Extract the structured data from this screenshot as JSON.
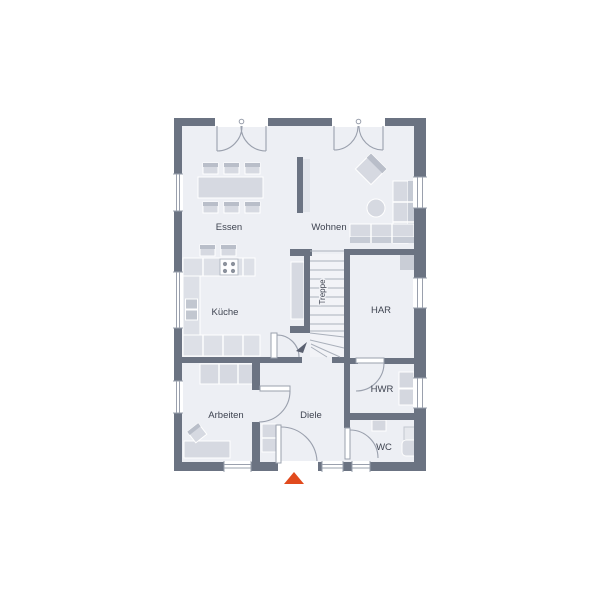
{
  "colors": {
    "wall": "#6b7382",
    "floor": "#edeff4",
    "furniture": "#d6d9e1",
    "furniture_dark": "#b9bec9",
    "counter": "#dde0e7",
    "line": "#9aa0ad",
    "label": "#3f4451",
    "accent": "#e14a1d",
    "stair_bg": "#f2f3f7"
  },
  "rooms": {
    "essen": {
      "label": "Essen"
    },
    "wohnen": {
      "label": "Wohnen"
    },
    "kueche": {
      "label": "Küche"
    },
    "treppe": {
      "label": "Treppe"
    },
    "har": {
      "label": "HAR"
    },
    "hwr": {
      "label": "HWR"
    },
    "arbeiten": {
      "label": "Arbeiten"
    },
    "diele": {
      "label": "Diele"
    },
    "wc": {
      "label": "WC"
    }
  },
  "entrance": {
    "marker": "entrance-arrow"
  }
}
